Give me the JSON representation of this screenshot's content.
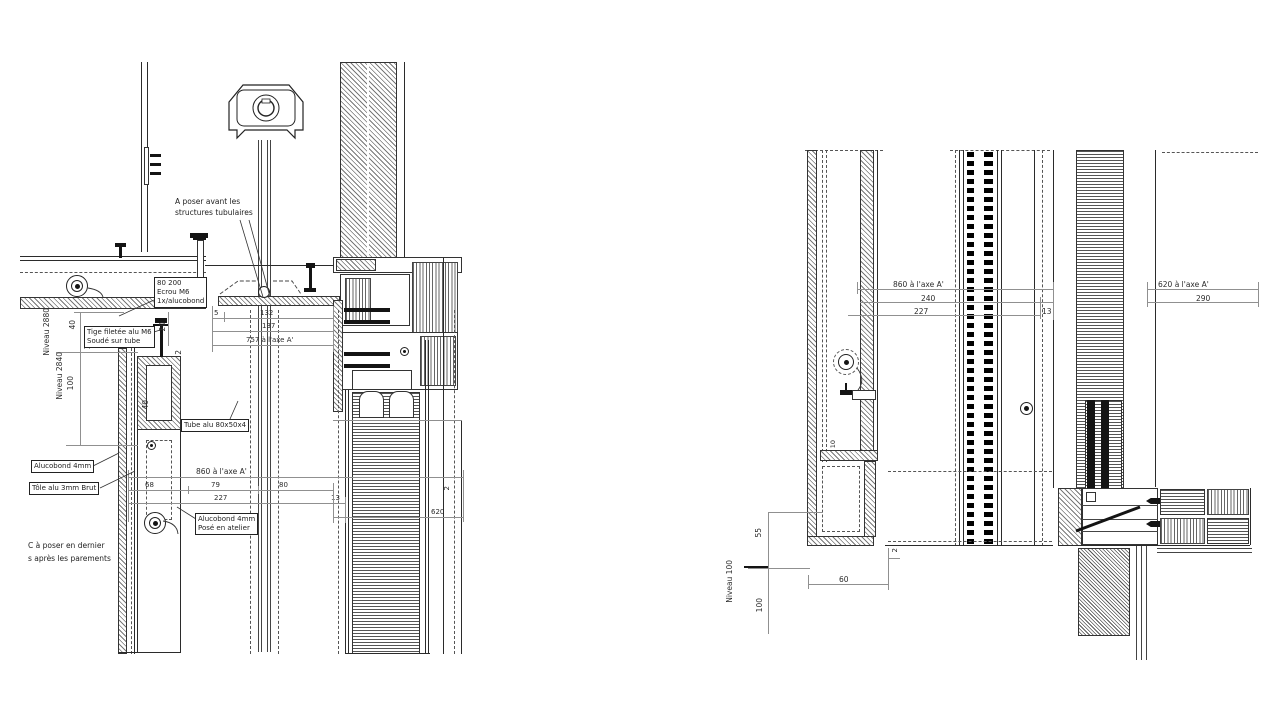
{
  "drawing": {
    "left_view": {
      "labels": {
        "note_tubular_1": "A poser avant les",
        "note_tubular_2": "structures tubulaires",
        "ecrou_1": "80 200",
        "ecrou_2": "Ecrou M6",
        "ecrou_3": "1x/alucobond",
        "tige_1": "Tige filetée alu M6",
        "tige_2": "Soudé sur tube",
        "tube": "Tube alu 80x50x4",
        "alucobond": "Alucobond 4mm",
        "tole": "Tôle alu 3mm Brut",
        "atelier_1": "Alucobond 4mm",
        "atelier_2": "Posé en atelier",
        "poser_1": "C à poser en dernier",
        "poser_2": "s après les parements",
        "niveau_2880": "Niveau 2880",
        "niveau_2840": "Niveau 2840"
      },
      "dims": {
        "d5": "5",
        "d132": "132",
        "d137": "137",
        "d757": "757 à l'axe A'",
        "d40a": "40",
        "d10": "10",
        "d100": "100",
        "d20": "20",
        "d2a": "2",
        "d40b": "40",
        "d68": "68",
        "d79": "79",
        "d80": "80",
        "d227": "227",
        "d13": "13",
        "d860": "860 à l'axe A'",
        "d2b": "2",
        "d620": "620"
      }
    },
    "right_view": {
      "dims": {
        "d860": "860 à l'axe A'",
        "d240": "240",
        "d227": "227",
        "d13": "13",
        "d620": "620 à l'axe A'",
        "d290": "290",
        "d55": "55",
        "niveau_100": "Niveau 100",
        "d100": "100",
        "d60": "60",
        "d2": "2",
        "d10": "10"
      }
    }
  }
}
